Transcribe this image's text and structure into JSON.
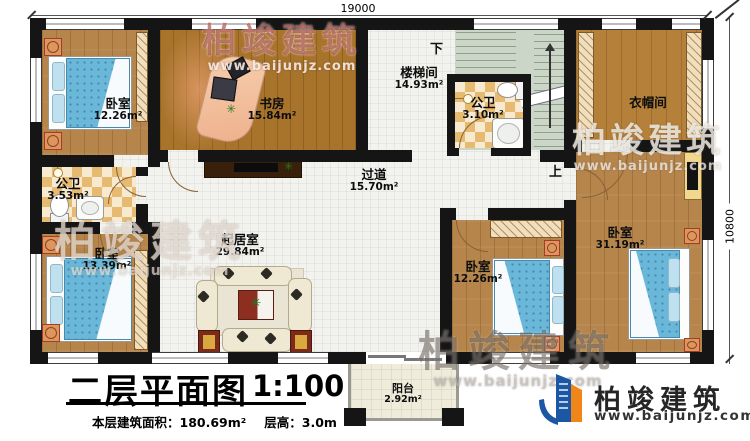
{
  "dimensions": {
    "top": "19000",
    "right": "10800"
  },
  "rooms": {
    "bedroom_top_left": {
      "name": "卧室",
      "area": "12.26m²"
    },
    "study": {
      "name": "书房",
      "area": "15.84m²"
    },
    "stairwell": {
      "name": "楼梯间",
      "area": "14.93m²"
    },
    "bath_top": {
      "name": "公卫",
      "area": "3.10m²"
    },
    "cloakroom": {
      "name": "衣帽间"
    },
    "bath_left": {
      "name": "公卫",
      "area": "3.53m²"
    },
    "hallway": {
      "name": "过道",
      "area": "15.70m²"
    },
    "living_room": {
      "name": "起居室",
      "area": "29.84m²"
    },
    "bedroom_bottom_left": {
      "name": "卧室",
      "area": "13.39m²"
    },
    "bedroom_bottom_middle": {
      "name": "卧室",
      "area": "12.26m²"
    },
    "bedroom_right": {
      "name": "卧室",
      "area": "31.19m²"
    },
    "balcony": {
      "name": "阳台",
      "area": "2.92m²"
    }
  },
  "stairs": {
    "down_label": "下",
    "up_label": "上"
  },
  "title_block": {
    "title": "二层平面图",
    "scale": "1:100",
    "floor_area_label": "本层建筑面积：180.69m²",
    "floor_height_label": "层高：3.0m"
  },
  "brand": {
    "name": "柏竣建筑",
    "website": "www.baijunjz.com"
  },
  "colors": {
    "brand_blue": "#1b57a5",
    "brand_orange": "#f08519",
    "wall": "#151515",
    "bed_blue": "#6ab8d9"
  }
}
